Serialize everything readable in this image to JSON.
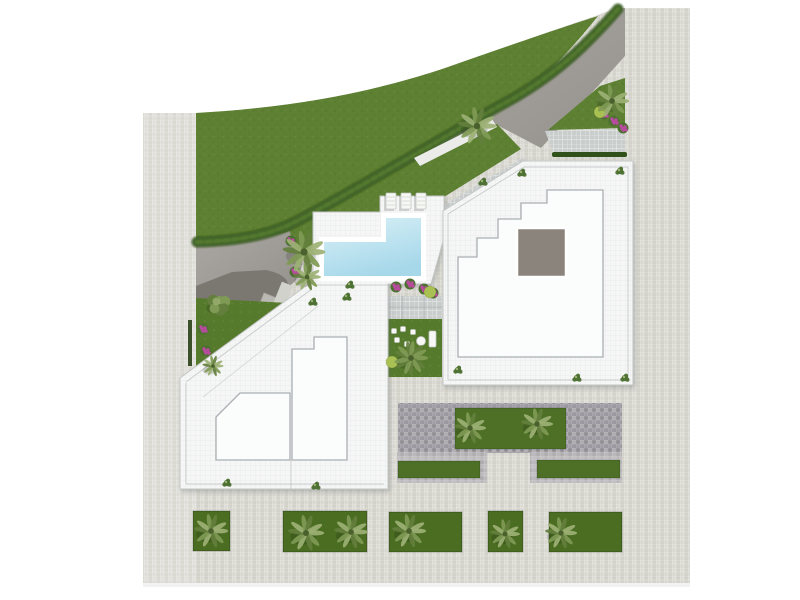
{
  "colors": {
    "page": "#ffffff",
    "tileA": "#dcdbd4",
    "tileB": "#d3d2ca",
    "tileC": "#d8d7d0",
    "tileD": "#cfcec6",
    "mosaicA": "#a29fa6",
    "mosaicB": "#908d94",
    "mosaicC": "#aeabb1",
    "mosaicD": "#9b98a0",
    "midA": "#bab8ba",
    "midB": "#aeacae",
    "midC": "#c2c0c2",
    "paver": "#c9cecd",
    "paverLine": "#e2e5e4",
    "road": "#aba8a3",
    "roadDark": "#94918c",
    "curb": "#ebecea",
    "lawn": "#5d8032",
    "lawnDot": "#4e6f28",
    "hedge": "#42652a",
    "hedgeDark": "#31511a",
    "hedgeLight": "#567d2e",
    "garden": "#567a2c",
    "planter": "#4a6d22",
    "stripGreen": "#4d7026",
    "buildingFill": "#f5f6f5",
    "buildingEdge": "#c3c7c6",
    "innerRoof": "#fbfcfc",
    "innerEdge": "#a9afb2",
    "roofSquare": "#8a847d",
    "gridLine": "rgba(70,80,85,0.08)",
    "poolTop": "#daf1f7",
    "poolBottom": "#a7d8ea",
    "poolStep": "#e6f5f8",
    "poolLine": "#f6fcfd",
    "coping": "#ffffff",
    "garage": "#7b7771",
    "slab": "#b9b8b2",
    "slabLight": "#d2d2cc",
    "wallHedge": "#3c512a",
    "palmLight": "#9cb174",
    "palmMid": "#7f9a55",
    "palmDark": "#647f3d",
    "palmCore": "#4a612e",
    "shrub": "#4c7030",
    "magenta": "#b84b9e",
    "lime": "#a9c052",
    "furniture": "#f7f8f6",
    "loungerEdge": "#c2c6c1",
    "shadow": "rgba(0,0,0,0.14)"
  },
  "scene": {
    "trees": [
      {
        "type": "palm",
        "x": 304,
        "y": 252,
        "r": 20
      },
      {
        "type": "palm",
        "x": 307,
        "y": 277,
        "r": 13
      },
      {
        "type": "palm",
        "x": 477,
        "y": 126,
        "r": 18
      },
      {
        "type": "palm",
        "x": 612,
        "y": 101,
        "r": 16
      },
      {
        "type": "palm",
        "x": 213,
        "y": 366,
        "r": 10
      },
      {
        "type": "tree",
        "x": 219,
        "y": 304,
        "r": 13
      },
      {
        "type": "fern",
        "x": 411,
        "y": 358,
        "r": 16
      },
      {
        "type": "palm",
        "x": 470,
        "y": 428,
        "r": 15
      },
      {
        "type": "palm",
        "x": 537,
        "y": 424,
        "r": 15
      },
      {
        "type": "palm",
        "x": 211,
        "y": 531,
        "r": 16
      },
      {
        "type": "palm",
        "x": 306,
        "y": 533,
        "r": 17
      },
      {
        "type": "palm",
        "x": 351,
        "y": 532,
        "r": 16
      },
      {
        "type": "palm",
        "x": 409,
        "y": 531,
        "r": 16
      },
      {
        "type": "palm",
        "x": 505,
        "y": 534,
        "r": 14
      },
      {
        "type": "palm",
        "x": 561,
        "y": 533,
        "r": 15
      }
    ],
    "shrubs": [
      [
        483,
        182
      ],
      [
        522,
        173
      ],
      [
        620,
        171
      ],
      [
        577,
        378
      ],
      [
        625,
        378
      ],
      [
        458,
        370
      ],
      [
        350,
        285
      ],
      [
        313,
        302
      ],
      [
        227,
        483
      ],
      [
        316,
        486
      ],
      [
        347,
        297
      ]
    ],
    "flowers": [
      [
        291,
        241
      ],
      [
        295,
        272
      ],
      [
        396,
        287
      ],
      [
        410,
        284
      ],
      [
        424,
        289
      ],
      [
        433,
        293
      ],
      [
        604,
        114
      ],
      [
        614,
        121
      ],
      [
        623,
        128
      ],
      [
        203,
        329
      ],
      [
        206,
        351
      ]
    ],
    "limes": [
      [
        392,
        362
      ],
      [
        600,
        112
      ],
      [
        430,
        292
      ]
    ],
    "planters": [
      [
        193,
        511,
        37,
        40
      ],
      [
        283,
        511,
        84,
        41
      ],
      [
        389,
        512,
        73,
        40
      ],
      [
        488,
        511,
        35,
        41
      ],
      [
        549,
        512,
        73,
        40
      ]
    ],
    "green_strips": [
      [
        398,
        461,
        82,
        17
      ],
      [
        537,
        460,
        83,
        18
      ],
      [
        455,
        408,
        111,
        41
      ]
    ],
    "loungers": [
      [
        386,
        193
      ],
      [
        401,
        193
      ],
      [
        416,
        193
      ]
    ],
    "furniture": {
      "chairs": [
        [
          394,
          331
        ],
        [
          403,
          329
        ],
        [
          413,
          332
        ],
        [
          397,
          340
        ],
        [
          407,
          344
        ]
      ],
      "table": [
        421,
        341
      ],
      "bench": [
        429,
        331,
        7,
        16
      ]
    }
  }
}
